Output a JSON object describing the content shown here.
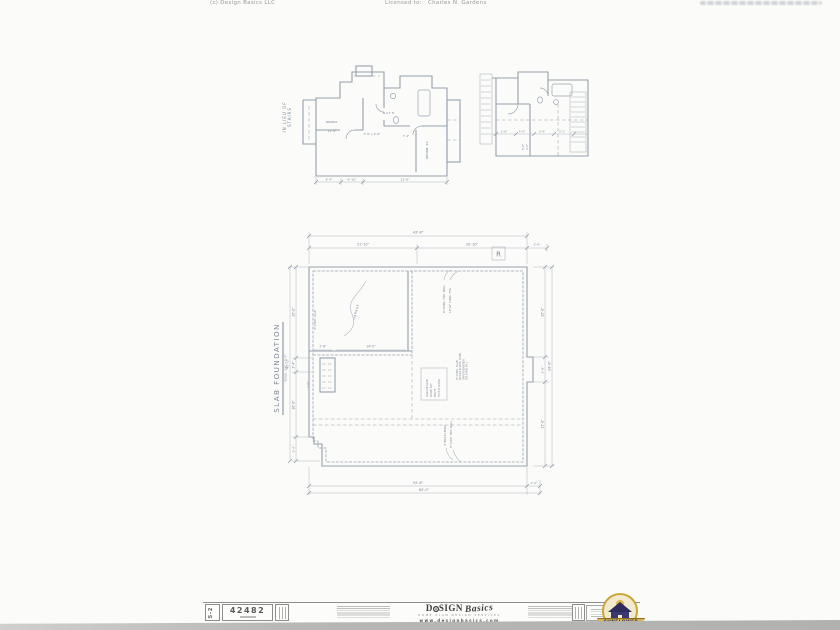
{
  "page": {
    "header_copyright": "(c) Design Basics LLC",
    "licensed_to_label": "Licensed to:",
    "licensee_name": "Charles N. Gardens"
  },
  "alt_plan": {
    "side_label_1": "IN LIEU OF",
    "side_label_2": "STAIRS",
    "room1_label": "BEDRM.",
    "room1_dim": "11'-0\"",
    "center_dim": "3'-0\" x 4'-8\"",
    "bath_label": "BATH",
    "room2_label": "BEDRM. #2",
    "hall_dim": "7'-4\"",
    "bottom_dim_1": "9'-4\"",
    "bottom_dim_2": "6'-10\"",
    "bottom_dim_3": "12'-8\""
  },
  "detail_plan": {
    "dim_1": "2'-8\"",
    "dim_2": "4'-0\"",
    "dim_3": "5'-4\"",
    "dim_4": "3'-1\"",
    "vdim_1": "6'-8\"",
    "vdim_2": "3'-0\""
  },
  "main_plan": {
    "title": "SLAB FOUNDATION",
    "scale_note": "SCALE: 1/4\" = 1'-0\"",
    "revision_marker": "R",
    "dim_top_overall": "43'-8\"",
    "dim_top_left": "21'-10\"",
    "dim_top_right": "20'-10\"",
    "dim_top_end": "2'-0\"",
    "dim_left_overall": "40'-0\"",
    "dim_left_seg1": "20'-8\"",
    "dim_left_seg2": "3'-4\"",
    "dim_left_seg3": "16'-0\"",
    "dim_right_overall": "34'-8\"",
    "dim_right_seg1": "20'-8\"",
    "dim_right_seg2": "2'-8\"",
    "dim_right_seg3": "11'-8\"",
    "dim_bottom_inner": "55'-8\"",
    "dim_bottom_overall": "60'-0\"",
    "dim_bottom_end": "2'-0\"",
    "dim_notch": "2'-4\"",
    "garage_label": "GARAGE",
    "garage_dim_a": "2'-8\"",
    "garage_dim_b": "14'-0\"",
    "garage_note": "4\" CONC. SLAB",
    "stoop_dim": "2'-0\"",
    "note_wall_1": "8\" CONC. FND. WALL",
    "note_wall_2": "16\"x8\" CONC. FTG.",
    "note_slab_1": "4\" CONC. SLAB",
    "note_slab_2": "W/ 6x6 W.W.M. OVER",
    "note_slab_3": "VAPOR BARRIER",
    "note_slab_4": "ON SAND FILL",
    "note_box_1": "GARAGE SLAB",
    "note_box_2": "SLOPE 1/8\"",
    "note_box_3": "PER FT.",
    "note_box_4": "TO O.H. DOOR",
    "note_bot_1": "4\" BRICK LEDGE",
    "note_bot_2": "8\" CONC. FND. WALL"
  },
  "titleblock": {
    "sheet_number": "S-2",
    "plan_number": "42482",
    "brand_d": "D",
    "brand_sign": "SIGN",
    "brand_basics": "Basics",
    "tagline": "HOME PLAN DESIGN SERVICES",
    "website": "www.designbasics.com",
    "sunflower_label": "SUNFLOWER"
  }
}
